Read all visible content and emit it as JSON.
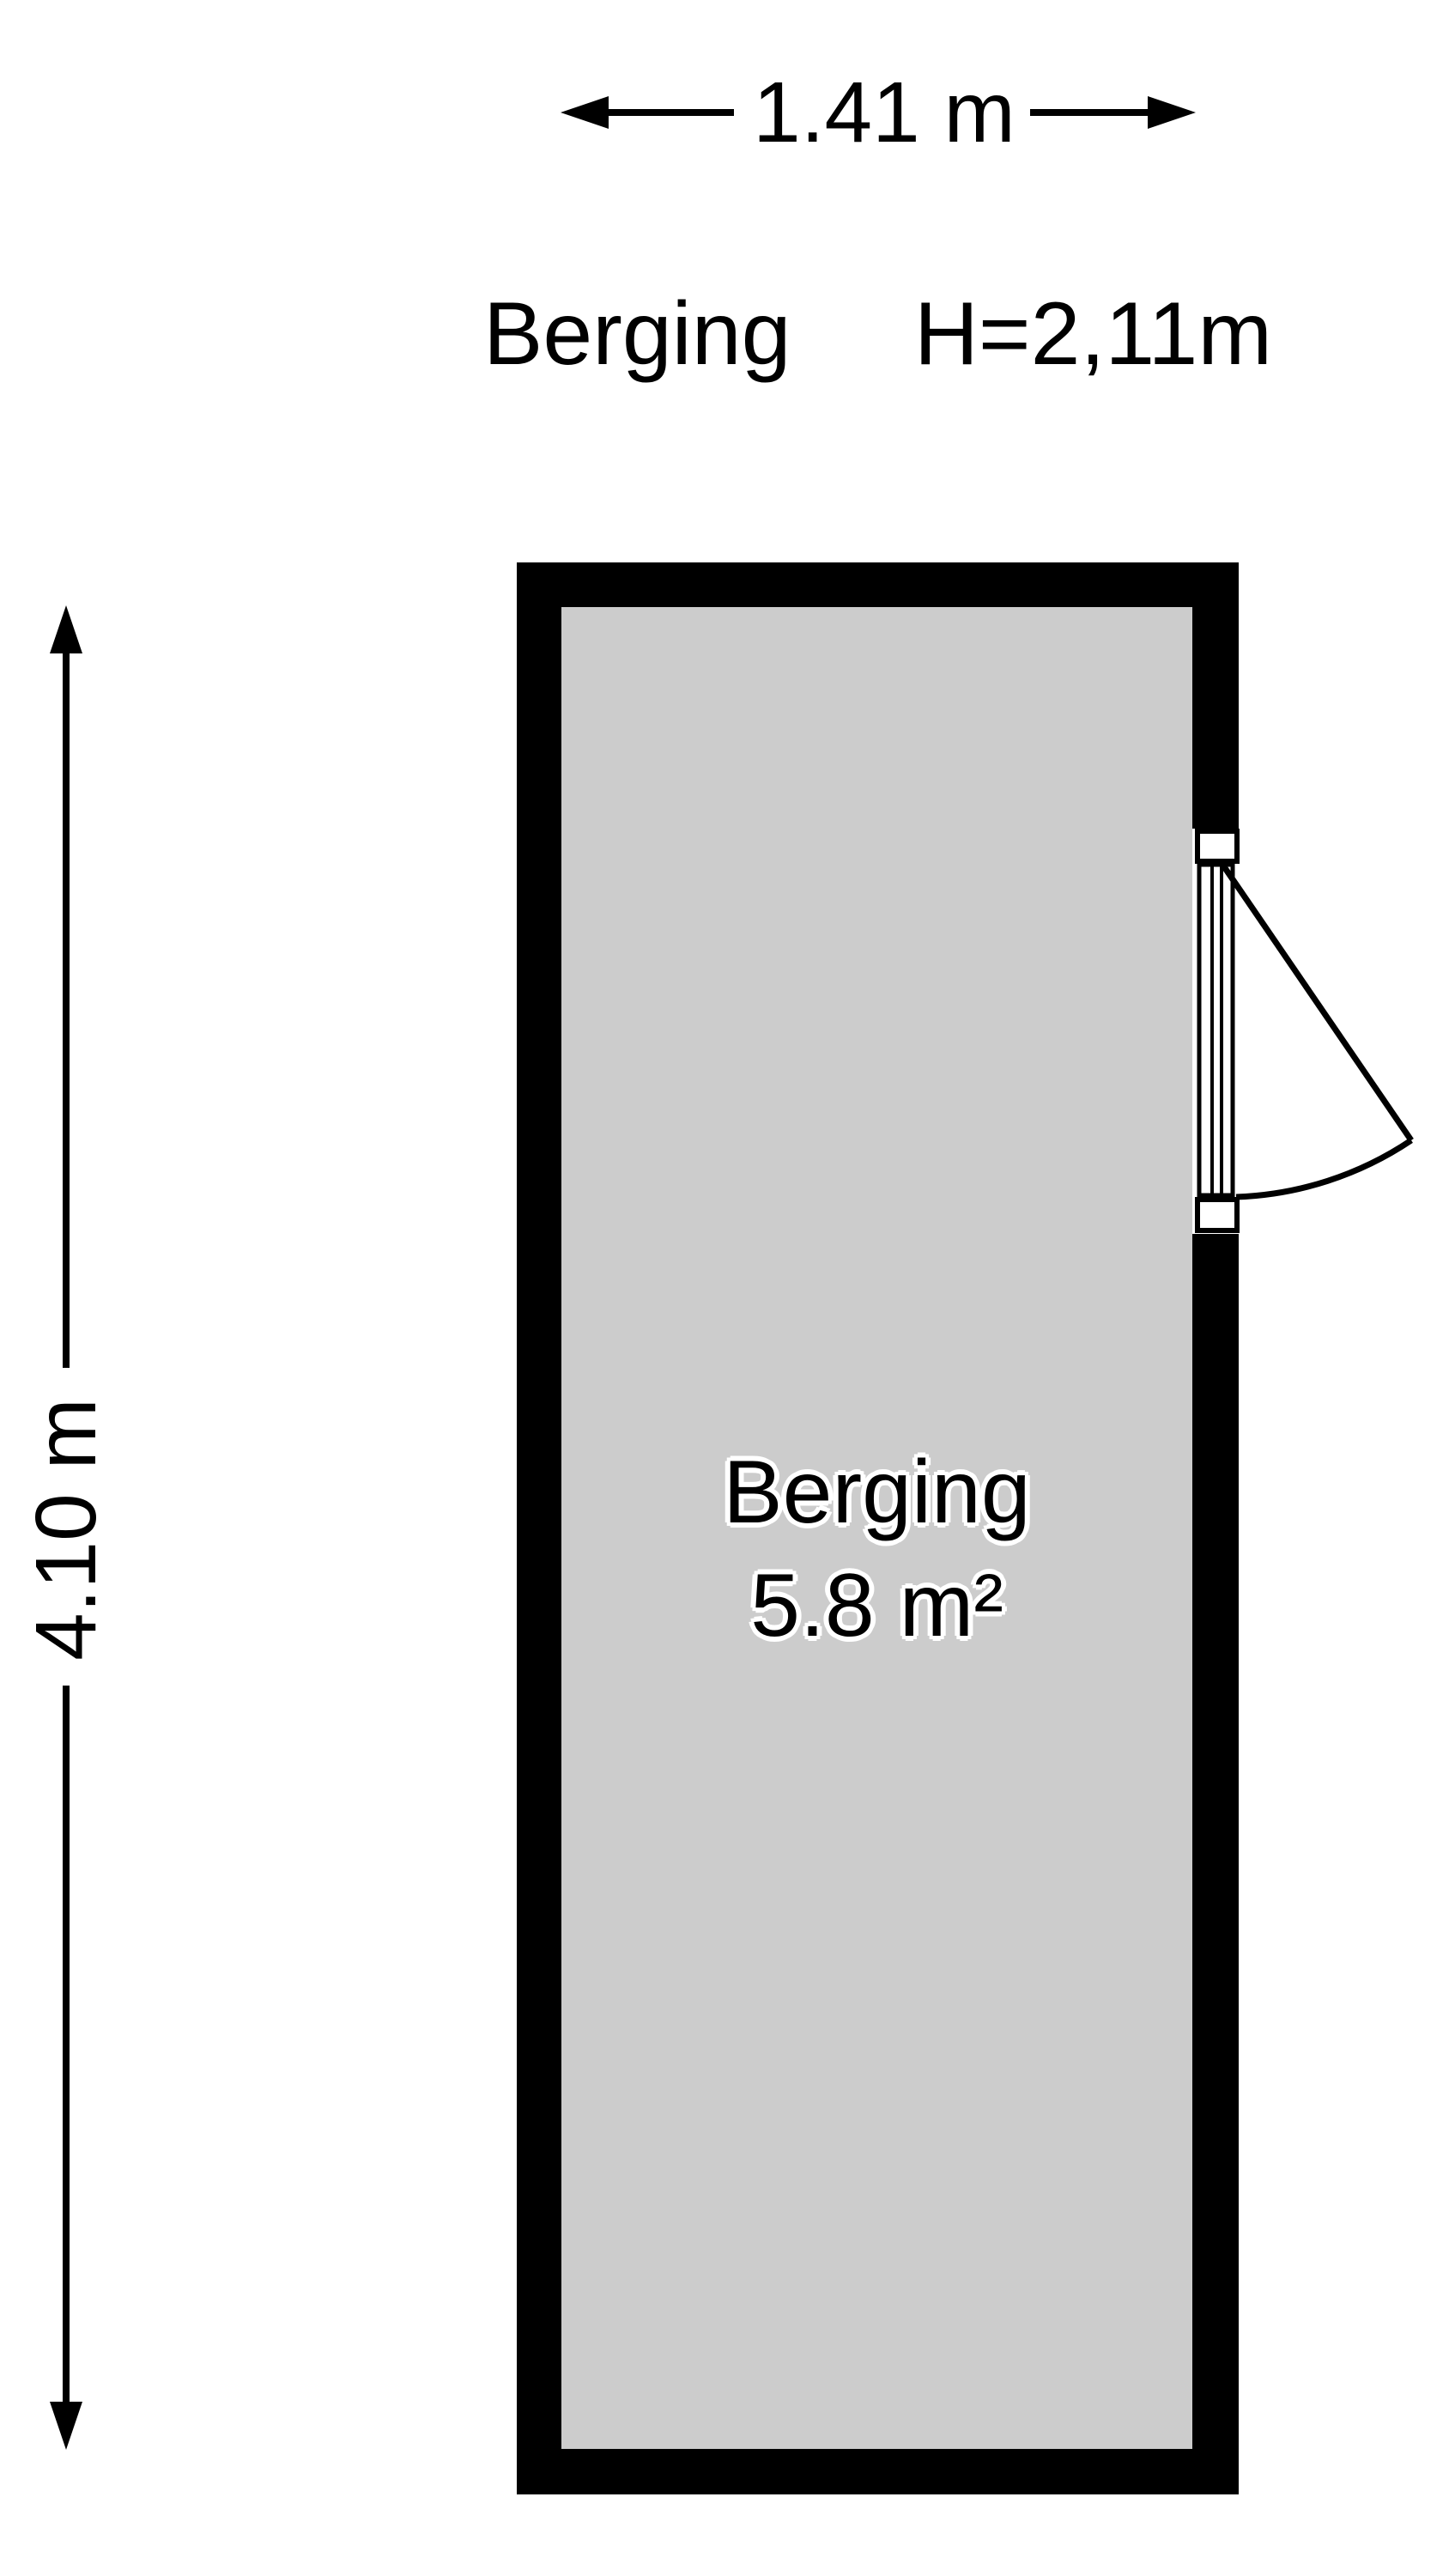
{
  "page": {
    "background_color": "#ffffff",
    "wall_color": "#000000",
    "floor_color": "#cccccc",
    "line_color": "#000000"
  },
  "header": {
    "room_name": "Berging",
    "ceiling_height": "H=2,11m"
  },
  "dimensions": {
    "width": {
      "label": "1.41 m"
    },
    "height": {
      "label": "4.10 m"
    }
  },
  "room": {
    "name": "Berging",
    "area": "5.8 m²"
  },
  "door": {
    "location": "right-wall",
    "swing": "outward"
  }
}
